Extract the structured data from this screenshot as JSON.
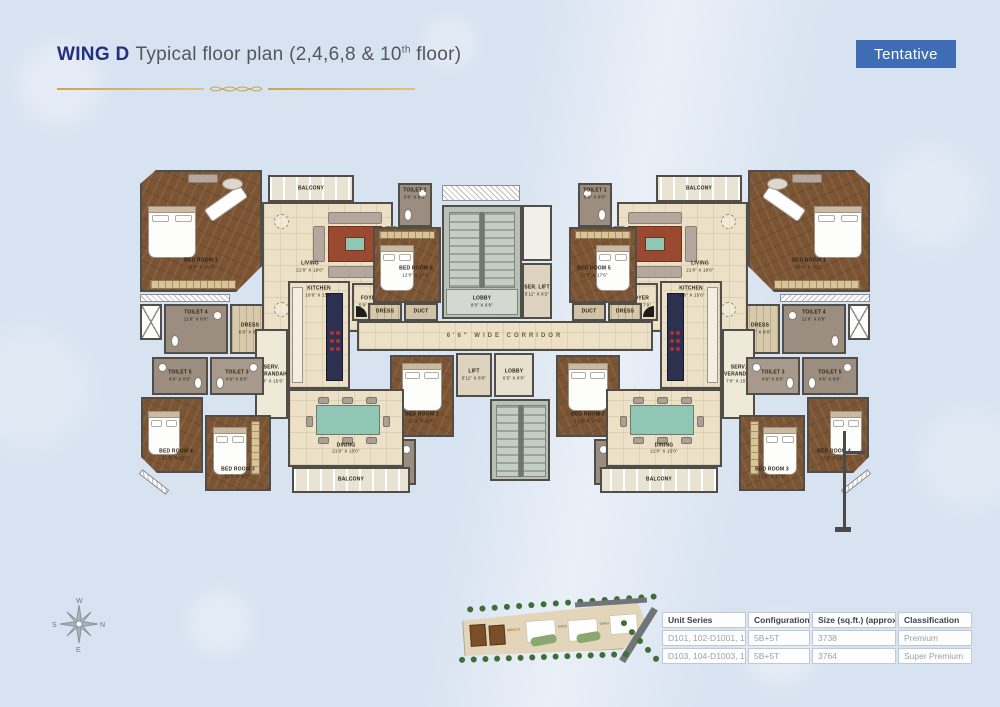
{
  "header": {
    "wing": "WING D",
    "title_main": "Typical floor plan (2,4,6,8 & 10",
    "title_sup": "th",
    "title_end": " floor)",
    "badge": "Tentative"
  },
  "compass": {
    "top": "W",
    "right": "N",
    "bottom": "E",
    "left": "S"
  },
  "corridor": {
    "label": "6'6\" WIDE CORRIDOR"
  },
  "core": {
    "lobby_top": "LOBBY",
    "lobby_top_dims": "8'0\" X 6'6\"",
    "ser_lift": "SER. LIFT",
    "ser_lift_dims": "5'11\" X 8'2\"",
    "lift": "LIFT",
    "lift_dims": "5'11\" X 8'0\"",
    "lobby_bottom": "LOBBY",
    "lobby_bottom_dims": "6'5\" X 8'0\""
  },
  "rooms": {
    "bedroom1": {
      "name": "BED ROOM 1",
      "dims": "20'0\" X 15'0\""
    },
    "bedroom2": {
      "name": "BED ROOM 2",
      "dims": "12'0\" X 17'6\""
    },
    "bedroom3": {
      "name": "BED ROOM 3",
      "dims": "11'6\" X 17'6\""
    },
    "bedroom4": {
      "name": "BED ROOM 4",
      "dims": "12'0\" X 15'0\""
    },
    "bedroom5": {
      "name": "BED ROOM 5",
      "dims": "12'0\" X 17'6\""
    },
    "living": {
      "name": "LIVING",
      "dims": "21'0\" X 19'0\""
    },
    "dining": {
      "name": "DINING",
      "dims": "21'0\" X 15'0\""
    },
    "kitchen": {
      "name": "KITCHEN",
      "dims": "10'6\" X 15'6\""
    },
    "foyer": {
      "name": "FOYER",
      "dims": "5'9\" X 7'9\""
    },
    "balcony_top": {
      "name": "BALCONY",
      "dims": "10'0\" X 6'0\""
    },
    "balcony_bottom": {
      "name": "BALCONY",
      "dims": "10'0\" X 6'0\""
    },
    "toilet1": {
      "name": "TOILET 1",
      "dims": "5'0\" X 8'0\""
    },
    "toilet2": {
      "name": "TOILET 2",
      "dims": "4'6\" X 8'0\""
    },
    "toilet3": {
      "name": "TOILET 3",
      "dims": "4'6\" X 8'0\""
    },
    "toilet4": {
      "name": "TOILET 4",
      "dims": "11'6\" X 8'0\""
    },
    "toilet5": {
      "name": "TOILET 5",
      "dims": "4'6\" X 8'0\""
    },
    "dress": {
      "name": "DRESS",
      "dims": "6'0\" X 8'0\""
    },
    "dress_small": {
      "name": "DRESS"
    },
    "duct": {
      "name": "DUCT"
    },
    "serv_verandah": {
      "name": "SERV. VERANDAH",
      "dims": "7'0\" X 15'6\""
    }
  },
  "sitemap": {
    "wings": [
      "WING D",
      "WING C",
      "WING B",
      "WING A"
    ]
  },
  "legend_table": {
    "headers": [
      "Unit Series",
      "Configuration",
      "Size (sq.ft.) (approx)",
      "Classification"
    ],
    "rows": [
      [
        "D101, 102-D1001, 1002",
        "5B+5T",
        "3738",
        "Premium"
      ],
      [
        "D103, 104-D1003, 1004",
        "5B+5T",
        "3764",
        "Super Premium"
      ]
    ]
  },
  "colors": {
    "badge_blue": "#3e6db5",
    "title_navy": "#262e7e",
    "gold": "#c8a44c",
    "wood": "#7b5433",
    "floor_cream": "#ece1c6",
    "core_gray": "#b9c0b6",
    "background": "#d8e3f1"
  }
}
